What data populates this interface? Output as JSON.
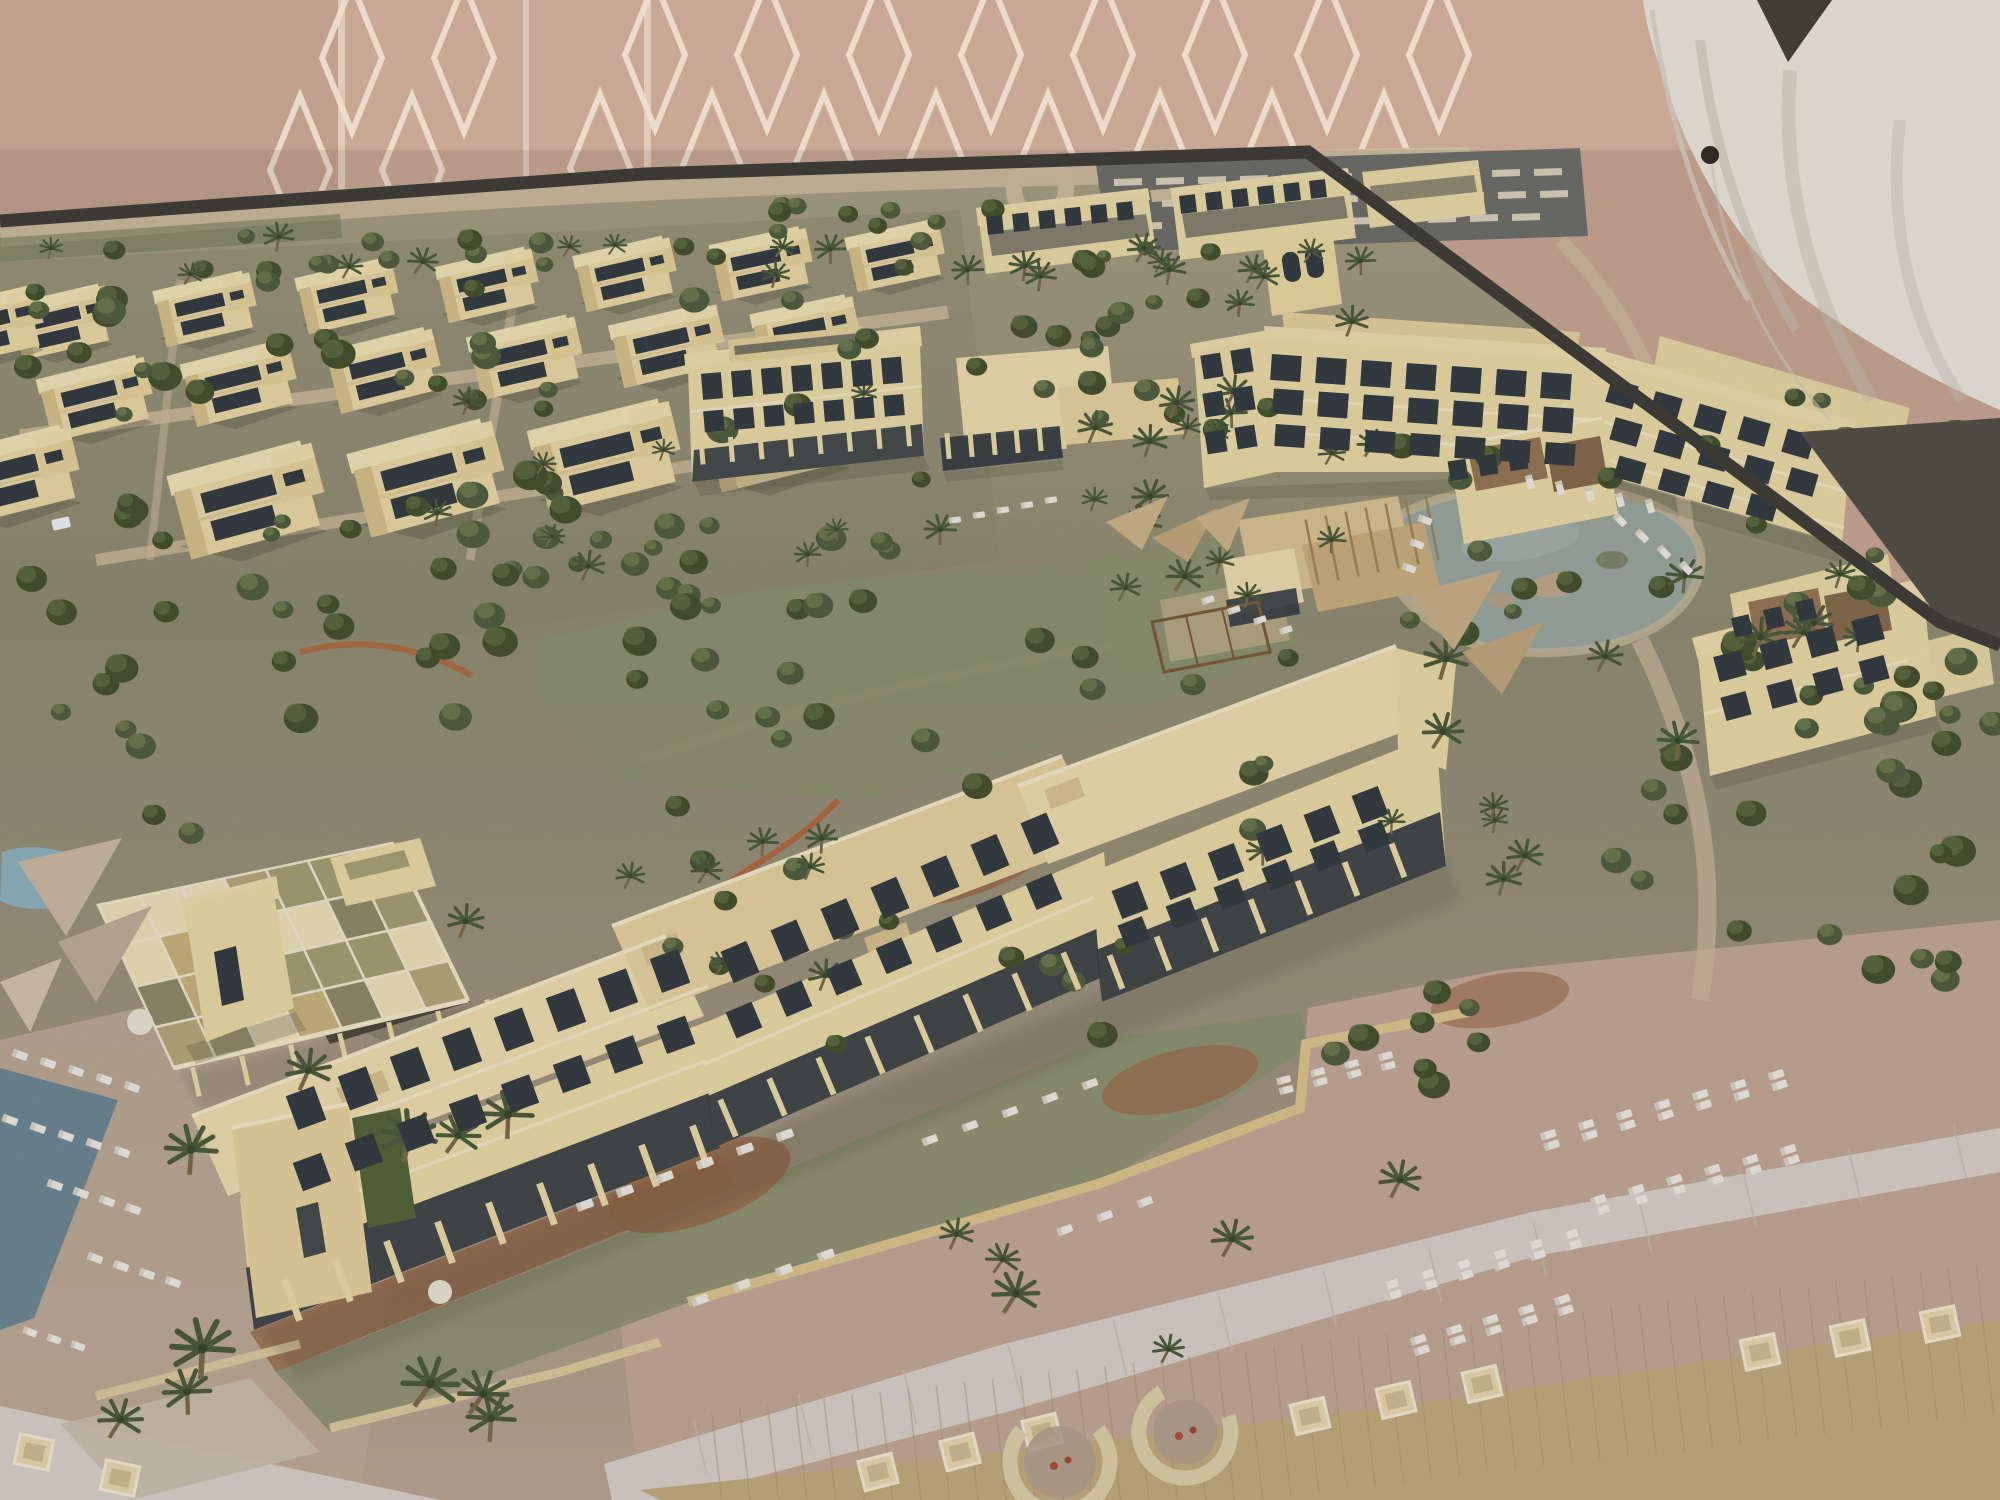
{
  "subject": "architectural-scale-model-of-desert-beach-resort",
  "palette": {
    "wall": "#c8a794",
    "wallDark": "#bb9a87",
    "wallSeam": "#e3cfc0",
    "wallPattern": "#eee1cf",
    "suit": "#d9d5cb",
    "suitShade": "#b9b2a5",
    "suitDark": "#403d33",
    "button": "#2e2b25",
    "edge": "#3c3a35",
    "shadowGap": "#4e4b43",
    "terrainTop": "#a89f86",
    "terrain": "#908d74",
    "terrainFront": "#b1a38f",
    "sandRoad": "#cdbb9e",
    "parking": "#6f706b",
    "stripe": "#d9cfba",
    "lawn": "#8e9372",
    "lawnDark": "#76805c",
    "bldg": "#eadaa8",
    "bldgShade": "#cdb584",
    "roofPale": "#ecdcae",
    "roofTan": "#dac394",
    "parapet": "#f3e8c8",
    "win": "#363d43",
    "water": "#9aa7a0",
    "shore": "#c6b698",
    "poolBlue": "#8fb2bf",
    "sea": "#6e8894",
    "mulch": "#9c6b4b",
    "redwall": "#b06a43",
    "gravel": "#c3a898",
    "stone": "#d7d1c8",
    "board": "#c2ab80",
    "plank": "#ab9571",
    "lounger": "#eceae2",
    "daybed": "#e6d8b0",
    "tree": "#46532f",
    "treeLight": "#5d6d44",
    "palmGreen": "#4d5c3e",
    "trunk": "#7b6a4e",
    "hedge": "#56663c",
    "brownTerrace": "#8d6b4c",
    "shadow": "#504e3e"
  },
  "scene": {
    "villas": [
      [
        62,
        318,
        0.85,
        -13
      ],
      [
        206,
        305,
        0.85,
        -13
      ],
      [
        348,
        292,
        0.85,
        -13
      ],
      [
        488,
        281,
        0.85,
        -13
      ],
      [
        626,
        270,
        0.85,
        -13
      ],
      [
        762,
        260,
        0.85,
        -12
      ],
      [
        896,
        252,
        0.82,
        -12
      ],
      [
        96,
        394,
        0.95,
        -14
      ],
      [
        240,
        379,
        0.95,
        -14
      ],
      [
        384,
        366,
        0.95,
        -14
      ],
      [
        526,
        353,
        0.95,
        -13
      ],
      [
        668,
        341,
        0.95,
        -13
      ],
      [
        806,
        330,
        0.9,
        -12
      ],
      [
        248,
        494,
        1.28,
        -15
      ],
      [
        428,
        472,
        1.28,
        -15
      ],
      [
        606,
        450,
        1.25,
        -14
      ],
      [
        776,
        432,
        1.2,
        -14
      ],
      [
        14,
        470,
        1.1,
        -14
      ],
      [
        -10,
        322,
        0.9,
        -13
      ]
    ],
    "tree_clusters": [
      {
        "x": 0,
        "y": 235,
        "w": 640,
        "h": 55,
        "n": 14,
        "s0": 0.7,
        "s1": 1.1,
        "kind": "tree",
        "seed": 11
      },
      {
        "x": 660,
        "y": 205,
        "w": 800,
        "h": 70,
        "n": 16,
        "s0": 0.6,
        "s1": 1.0,
        "kind": "tree",
        "seed": 12
      },
      {
        "x": 0,
        "y": 290,
        "w": 960,
        "h": 330,
        "n": 56,
        "s0": 0.7,
        "s1": 1.35,
        "kind": "tree",
        "seed": 13
      },
      {
        "x": 960,
        "y": 250,
        "w": 330,
        "h": 180,
        "n": 18,
        "s0": 0.7,
        "s1": 1.2,
        "kind": "tree",
        "seed": 14
      },
      {
        "x": 420,
        "y": 470,
        "w": 360,
        "h": 260,
        "n": 16,
        "s0": 0.8,
        "s1": 1.4,
        "kind": "tree",
        "seed": 15
      },
      {
        "x": 560,
        "y": 600,
        "w": 760,
        "h": 280,
        "n": 22,
        "s0": 0.7,
        "s1": 1.3,
        "kind": "tree",
        "seed": 16
      },
      {
        "x": 1380,
        "y": 430,
        "w": 340,
        "h": 250,
        "n": 12,
        "s0": 0.7,
        "s1": 1.2,
        "kind": "tree",
        "seed": 17
      },
      {
        "x": 1600,
        "y": 560,
        "w": 380,
        "h": 420,
        "n": 26,
        "s0": 0.8,
        "s1": 1.5,
        "kind": "tree",
        "seed": 18
      },
      {
        "x": 1880,
        "y": 640,
        "w": 115,
        "h": 260,
        "n": 10,
        "s0": 0.8,
        "s1": 1.4,
        "kind": "tree",
        "seed": 19
      },
      {
        "x": 620,
        "y": 900,
        "w": 520,
        "h": 150,
        "n": 12,
        "s0": 0.7,
        "s1": 1.2,
        "kind": "tree",
        "seed": 20
      },
      {
        "x": 1310,
        "y": 960,
        "w": 260,
        "h": 140,
        "n": 8,
        "s0": 0.8,
        "s1": 1.3,
        "kind": "tree",
        "seed": 21
      },
      {
        "x": 60,
        "y": 600,
        "w": 360,
        "h": 260,
        "n": 14,
        "s0": 0.8,
        "s1": 1.4,
        "kind": "tree",
        "seed": 22
      },
      {
        "x": 1850,
        "y": 430,
        "w": 130,
        "h": 160,
        "n": 8,
        "s0": 0.7,
        "s1": 1.2,
        "kind": "tree",
        "seed": 23
      },
      {
        "x": 1690,
        "y": 380,
        "w": 200,
        "h": 150,
        "n": 8,
        "s0": 0.7,
        "s1": 1.1,
        "kind": "tree",
        "seed": 24
      }
    ],
    "palm_clusters": [
      {
        "x": 40,
        "y": 228,
        "w": 1380,
        "h": 50,
        "n": 20,
        "s0": 0.8,
        "s1": 1.2,
        "kind": "palm",
        "seed": 31
      },
      {
        "x": 300,
        "y": 330,
        "w": 650,
        "h": 260,
        "n": 10,
        "s0": 0.8,
        "s1": 1.2,
        "kind": "palm",
        "seed": 32
      },
      {
        "x": 1000,
        "y": 280,
        "w": 420,
        "h": 180,
        "n": 12,
        "s0": 0.8,
        "s1": 1.3,
        "kind": "palm",
        "seed": 33
      },
      {
        "x": 1090,
        "y": 480,
        "w": 260,
        "h": 140,
        "n": 8,
        "s0": 0.9,
        "s1": 1.3,
        "kind": "palm",
        "seed": 34
      },
      {
        "x": 1440,
        "y": 560,
        "w": 420,
        "h": 340,
        "n": 10,
        "s0": 1.0,
        "s1": 1.6,
        "kind": "palm",
        "seed": 35
      },
      {
        "x": 80,
        "y": 1060,
        "w": 430,
        "h": 380,
        "n": 11,
        "s0": 1.5,
        "s1": 2.4,
        "kind": "palm",
        "seed": 36
      },
      {
        "x": 900,
        "y": 1130,
        "w": 520,
        "h": 220,
        "n": 6,
        "s0": 1.1,
        "s1": 1.7,
        "kind": "palm",
        "seed": 37
      },
      {
        "x": 420,
        "y": 760,
        "w": 420,
        "h": 240,
        "n": 8,
        "s0": 0.9,
        "s1": 1.3,
        "kind": "palm",
        "seed": 38
      },
      {
        "x": 1240,
        "y": 700,
        "w": 300,
        "h": 200,
        "n": 6,
        "s0": 0.9,
        "s1": 1.3,
        "kind": "palm",
        "seed": 39
      }
    ],
    "lounger_rows": [
      {
        "x": 1530,
        "y": 482,
        "dx": 30,
        "dy": 6,
        "n": 5,
        "rot": 75,
        "pair": false,
        "s": 1
      },
      {
        "x": 1620,
        "y": 520,
        "dx": 22,
        "dy": 16,
        "n": 4,
        "rot": 45,
        "pair": false,
        "s": 1
      },
      {
        "x": 1425,
        "y": 520,
        "dx": -8,
        "dy": 24,
        "n": 3,
        "rot": 20,
        "pair": false,
        "s": 1
      },
      {
        "x": 1392,
        "y": 1290,
        "dx": 36,
        "dy": -10,
        "n": 6,
        "rot": -18,
        "pair": true,
        "s": 1.1
      },
      {
        "x": 1420,
        "y": 1345,
        "dx": 36,
        "dy": -10,
        "n": 5,
        "rot": -18,
        "pair": true,
        "s": 1.1
      },
      {
        "x": 1550,
        "y": 1140,
        "dx": 38,
        "dy": -10,
        "n": 7,
        "rot": -18,
        "pair": true,
        "s": 1.1
      },
      {
        "x": 1600,
        "y": 1205,
        "dx": 38,
        "dy": -10,
        "n": 6,
        "rot": -18,
        "pair": true,
        "s": 1.1
      },
      {
        "x": 1285,
        "y": 1085,
        "dx": 34,
        "dy": -8,
        "n": 4,
        "rot": -15,
        "pair": true,
        "s": 1
      },
      {
        "x": 585,
        "y": 1205,
        "dx": 40,
        "dy": -14,
        "n": 6,
        "rot": -20,
        "pair": false,
        "s": 1.2
      },
      {
        "x": 700,
        "y": 1300,
        "dx": 42,
        "dy": -15,
        "n": 4,
        "rot": -20,
        "pair": false,
        "s": 1.2
      },
      {
        "x": 930,
        "y": 1140,
        "dx": 40,
        "dy": -14,
        "n": 5,
        "rot": -20,
        "pair": false,
        "s": 1.1
      },
      {
        "x": 1065,
        "y": 1230,
        "dx": 40,
        "dy": -14,
        "n": 3,
        "rot": -20,
        "pair": false,
        "s": 1.1
      },
      {
        "x": 20,
        "y": 1055,
        "dx": 28,
        "dy": 8,
        "n": 5,
        "rot": 20,
        "pair": false,
        "s": 1.1
      },
      {
        "x": 10,
        "y": 1120,
        "dx": 28,
        "dy": 8,
        "n": 5,
        "rot": 20,
        "pair": false,
        "s": 1.1
      },
      {
        "x": 55,
        "y": 1185,
        "dx": 26,
        "dy": 8,
        "n": 4,
        "rot": 20,
        "pair": false,
        "s": 1.1
      },
      {
        "x": 95,
        "y": 1258,
        "dx": 26,
        "dy": 8,
        "n": 4,
        "rot": 20,
        "pair": false,
        "s": 1.1
      },
      {
        "x": 30,
        "y": 1332,
        "dx": 24,
        "dy": 7,
        "n": 3,
        "rot": 20,
        "pair": false,
        "s": 1
      },
      {
        "x": 1208,
        "y": 600,
        "dx": 26,
        "dy": 10,
        "n": 4,
        "rot": -18,
        "pair": false,
        "s": 0.9
      },
      {
        "x": 955,
        "y": 520,
        "dx": 24,
        "dy": -5,
        "n": 5,
        "rot": -8,
        "pair": false,
        "s": 0.85
      }
    ],
    "window_rows": [
      {
        "x": 712,
        "y": 386,
        "dx": 30,
        "dy": -2.6,
        "n": 7,
        "w": 20,
        "h": 26,
        "rot": -5
      },
      {
        "x": 714,
        "y": 421,
        "dx": 30,
        "dy": -2.6,
        "n": 7,
        "w": 20,
        "h": 21,
        "rot": -5
      },
      {
        "x": 702,
        "y": 452,
        "dx": 29.5,
        "dy": -2.6,
        "n": 8,
        "w": 5,
        "h": 25,
        "rot": -5,
        "c": "bldg"
      },
      {
        "x": 948,
        "y": 446,
        "dx": 23,
        "dy": -2,
        "n": 6,
        "w": 5,
        "h": 26,
        "rot": -5,
        "c": "bldg"
      },
      {
        "x": 1212,
        "y": 366,
        "dx": 30,
        "dy": -5,
        "n": 2,
        "w": 20,
        "h": 24,
        "rot": -9
      },
      {
        "x": 1214,
        "y": 404,
        "dx": 30,
        "dy": -5,
        "n": 2,
        "w": 20,
        "h": 24,
        "rot": -9
      },
      {
        "x": 1216,
        "y": 442,
        "dx": 30,
        "dy": -5,
        "n": 2,
        "w": 20,
        "h": 22,
        "rot": -9
      },
      {
        "x": 1286,
        "y": 368,
        "dx": 45,
        "dy": 3,
        "n": 7,
        "w": 30,
        "h": 26,
        "rot": 4
      },
      {
        "x": 1288,
        "y": 402,
        "dx": 45,
        "dy": 3,
        "n": 7,
        "w": 30,
        "h": 25,
        "rot": 4
      },
      {
        "x": 1290,
        "y": 436,
        "dx": 45,
        "dy": 3,
        "n": 7,
        "w": 30,
        "h": 22,
        "rot": 4
      },
      {
        "x": 1622,
        "y": 394,
        "dx": 44,
        "dy": 12.5,
        "n": 5,
        "w": 28,
        "h": 24,
        "rot": 16
      },
      {
        "x": 1626,
        "y": 432,
        "dx": 44,
        "dy": 12.5,
        "n": 5,
        "w": 28,
        "h": 23,
        "rot": 16
      },
      {
        "x": 1630,
        "y": 470,
        "dx": 44,
        "dy": 12.5,
        "n": 4,
        "w": 28,
        "h": 22,
        "rot": 16
      },
      {
        "x": 1730,
        "y": 666,
        "dx": 46,
        "dy": -12,
        "n": 4,
        "w": 28,
        "h": 26,
        "rot": -15
      },
      {
        "x": 1736,
        "y": 706,
        "dx": 46,
        "dy": -12,
        "n": 4,
        "w": 26,
        "h": 24,
        "rot": -15
      },
      {
        "x": 306,
        "y": 1108,
        "dx": 52,
        "dy": -19.6,
        "n": 8,
        "w": 30,
        "h": 36,
        "rot": -20
      },
      {
        "x": 312,
        "y": 1172,
        "dx": 52,
        "dy": -19.6,
        "n": 8,
        "w": 30,
        "h": 30,
        "rot": -20
      },
      {
        "x": 292,
        "y": 1300,
        "dx": 51,
        "dy": -19.2,
        "n": 9,
        "w": 7,
        "h": 44,
        "rot": -20,
        "c": "bldg"
      },
      {
        "x": 740,
        "y": 962,
        "dx": 50,
        "dy": -21.4,
        "n": 7,
        "w": 28,
        "h": 34,
        "rot": -23
      },
      {
        "x": 744,
        "y": 1020,
        "dx": 50,
        "dy": -21.4,
        "n": 7,
        "w": 28,
        "h": 28,
        "rot": -23
      },
      {
        "x": 728,
        "y": 1118,
        "dx": 49,
        "dy": -21,
        "n": 8,
        "w": 6,
        "h": 40,
        "rot": -23,
        "c": "bldg"
      },
      {
        "x": 1130,
        "y": 900,
        "dx": 48,
        "dy": -19,
        "n": 6,
        "w": 28,
        "h": 30,
        "rot": -21
      },
      {
        "x": 1134,
        "y": 932,
        "dx": 48,
        "dy": -19,
        "n": 6,
        "w": 26,
        "h": 24,
        "rot": -21
      },
      {
        "x": 1116,
        "y": 972,
        "dx": 47,
        "dy": -18.6,
        "n": 7,
        "w": 6,
        "h": 36,
        "rot": -21,
        "c": "bldg"
      },
      {
        "x": 995,
        "y": 225,
        "dx": 26,
        "dy": -2.8,
        "n": 6,
        "w": 16,
        "h": 18,
        "rot": -6
      },
      {
        "x": 1188,
        "y": 204,
        "dx": 26,
        "dy": -3,
        "n": 6,
        "w": 16,
        "h": 18,
        "rot": -7
      },
      {
        "x": 1458,
        "y": 470,
        "dx": 30,
        "dy": -5,
        "n": 3,
        "w": 18,
        "h": 20,
        "rot": -9
      },
      {
        "x": 1742,
        "y": 626,
        "dx": 32,
        "dy": -8,
        "n": 3,
        "w": 18,
        "h": 20,
        "rot": -13
      }
    ],
    "parking_rows": [
      {
        "x": 1128,
        "y": 182,
        "dx": 42,
        "dy": -1,
        "n": 11,
        "w": 28,
        "h": 7,
        "rot": -2,
        "c": "stripe"
      },
      {
        "x": 1134,
        "y": 204,
        "dx": 42,
        "dy": -1,
        "n": 11,
        "w": 28,
        "h": 7,
        "rot": -2,
        "c": "stripe"
      },
      {
        "x": 1148,
        "y": 226,
        "dx": 42,
        "dy": -1,
        "n": 10,
        "w": 28,
        "h": 7,
        "rot": -2,
        "c": "stripe"
      }
    ],
    "daybed_rows": [
      {
        "x": 878,
        "y": 1472,
        "dx": 82,
        "dy": -20,
        "n": 3,
        "rot": -14
      },
      {
        "x": 1310,
        "y": 1416,
        "dx": 86,
        "dy": -16,
        "n": 3,
        "rot": -13
      },
      {
        "x": 1760,
        "y": 1352,
        "dx": 90,
        "dy": -14,
        "n": 3,
        "rot": -12
      },
      {
        "x": 34,
        "y": 1452,
        "dx": 86,
        "dy": 26,
        "n": 2,
        "rot": 12
      }
    ],
    "fire_pits": [
      {
        "x": 1060,
        "y": 1462,
        "r": 50,
        "rot": -40
      },
      {
        "x": 1185,
        "y": 1432,
        "r": 46,
        "rot": -20
      }
    ],
    "pergola": {
      "quad": [
        [
          98,
          905
        ],
        [
          392,
          843
        ],
        [
          468,
          1000
        ],
        [
          174,
          1068
        ]
      ],
      "cols": 7,
      "rows": 4,
      "seed": 7,
      "colors": [
        "#ece0b8",
        "#a59f74",
        "#c8b27e",
        "#ece0b8",
        "#b5a87c",
        "#8f8c6a"
      ]
    },
    "diamond_rows": [
      {
        "x0": 352,
        "x1": 520,
        "y": 58,
        "step": 112,
        "rx": 30,
        "ry": 74
      },
      {
        "x0": 300,
        "x1": 520,
        "y": 170,
        "step": 112,
        "rx": 30,
        "ry": 74
      },
      {
        "x0": 655,
        "x1": 1470,
        "y": 55,
        "step": 112,
        "rx": 30,
        "ry": 74
      },
      {
        "x0": 600,
        "x1": 1470,
        "y": 168,
        "step": 112,
        "rx": 30,
        "ry": 74
      }
    ],
    "plank_lines": {
      "x1": 720,
      "y1": 1486,
      "x2": 1985,
      "y2": 1340,
      "n": 46,
      "len": 150
    },
    "joint_lines": {
      "x1": 700,
      "y1": 1446,
      "x2": 1960,
      "y2": 1152,
      "n": 13,
      "len": 56
    },
    "slat_lines": {
      "x1": 1312,
      "y1": 552,
      "x2": 1432,
      "y2": 528,
      "n": 7,
      "len": 66
    },
    "sails": [
      {
        "pts": "18,862 122,838 66,936",
        "c": "#cbb9a4"
      },
      {
        "pts": "58,942 152,906 96,1002",
        "c": "#bfae9b"
      },
      {
        "pts": "0,982 62,958 30,1032",
        "c": "#d3c3ae"
      },
      {
        "pts": "1408,594 1502,570 1454,650",
        "c": "#c9b089"
      },
      {
        "pts": "1462,652 1544,622 1502,694",
        "c": "#bfa67e"
      },
      {
        "pts": "1106,522 1168,496 1142,550",
        "c": "#cdb58b"
      },
      {
        "pts": "1152,538 1218,508 1188,562",
        "c": "#c3a87e"
      },
      {
        "pts": "1196,518 1250,498 1228,552",
        "c": "#cdb58b"
      }
    ]
  }
}
